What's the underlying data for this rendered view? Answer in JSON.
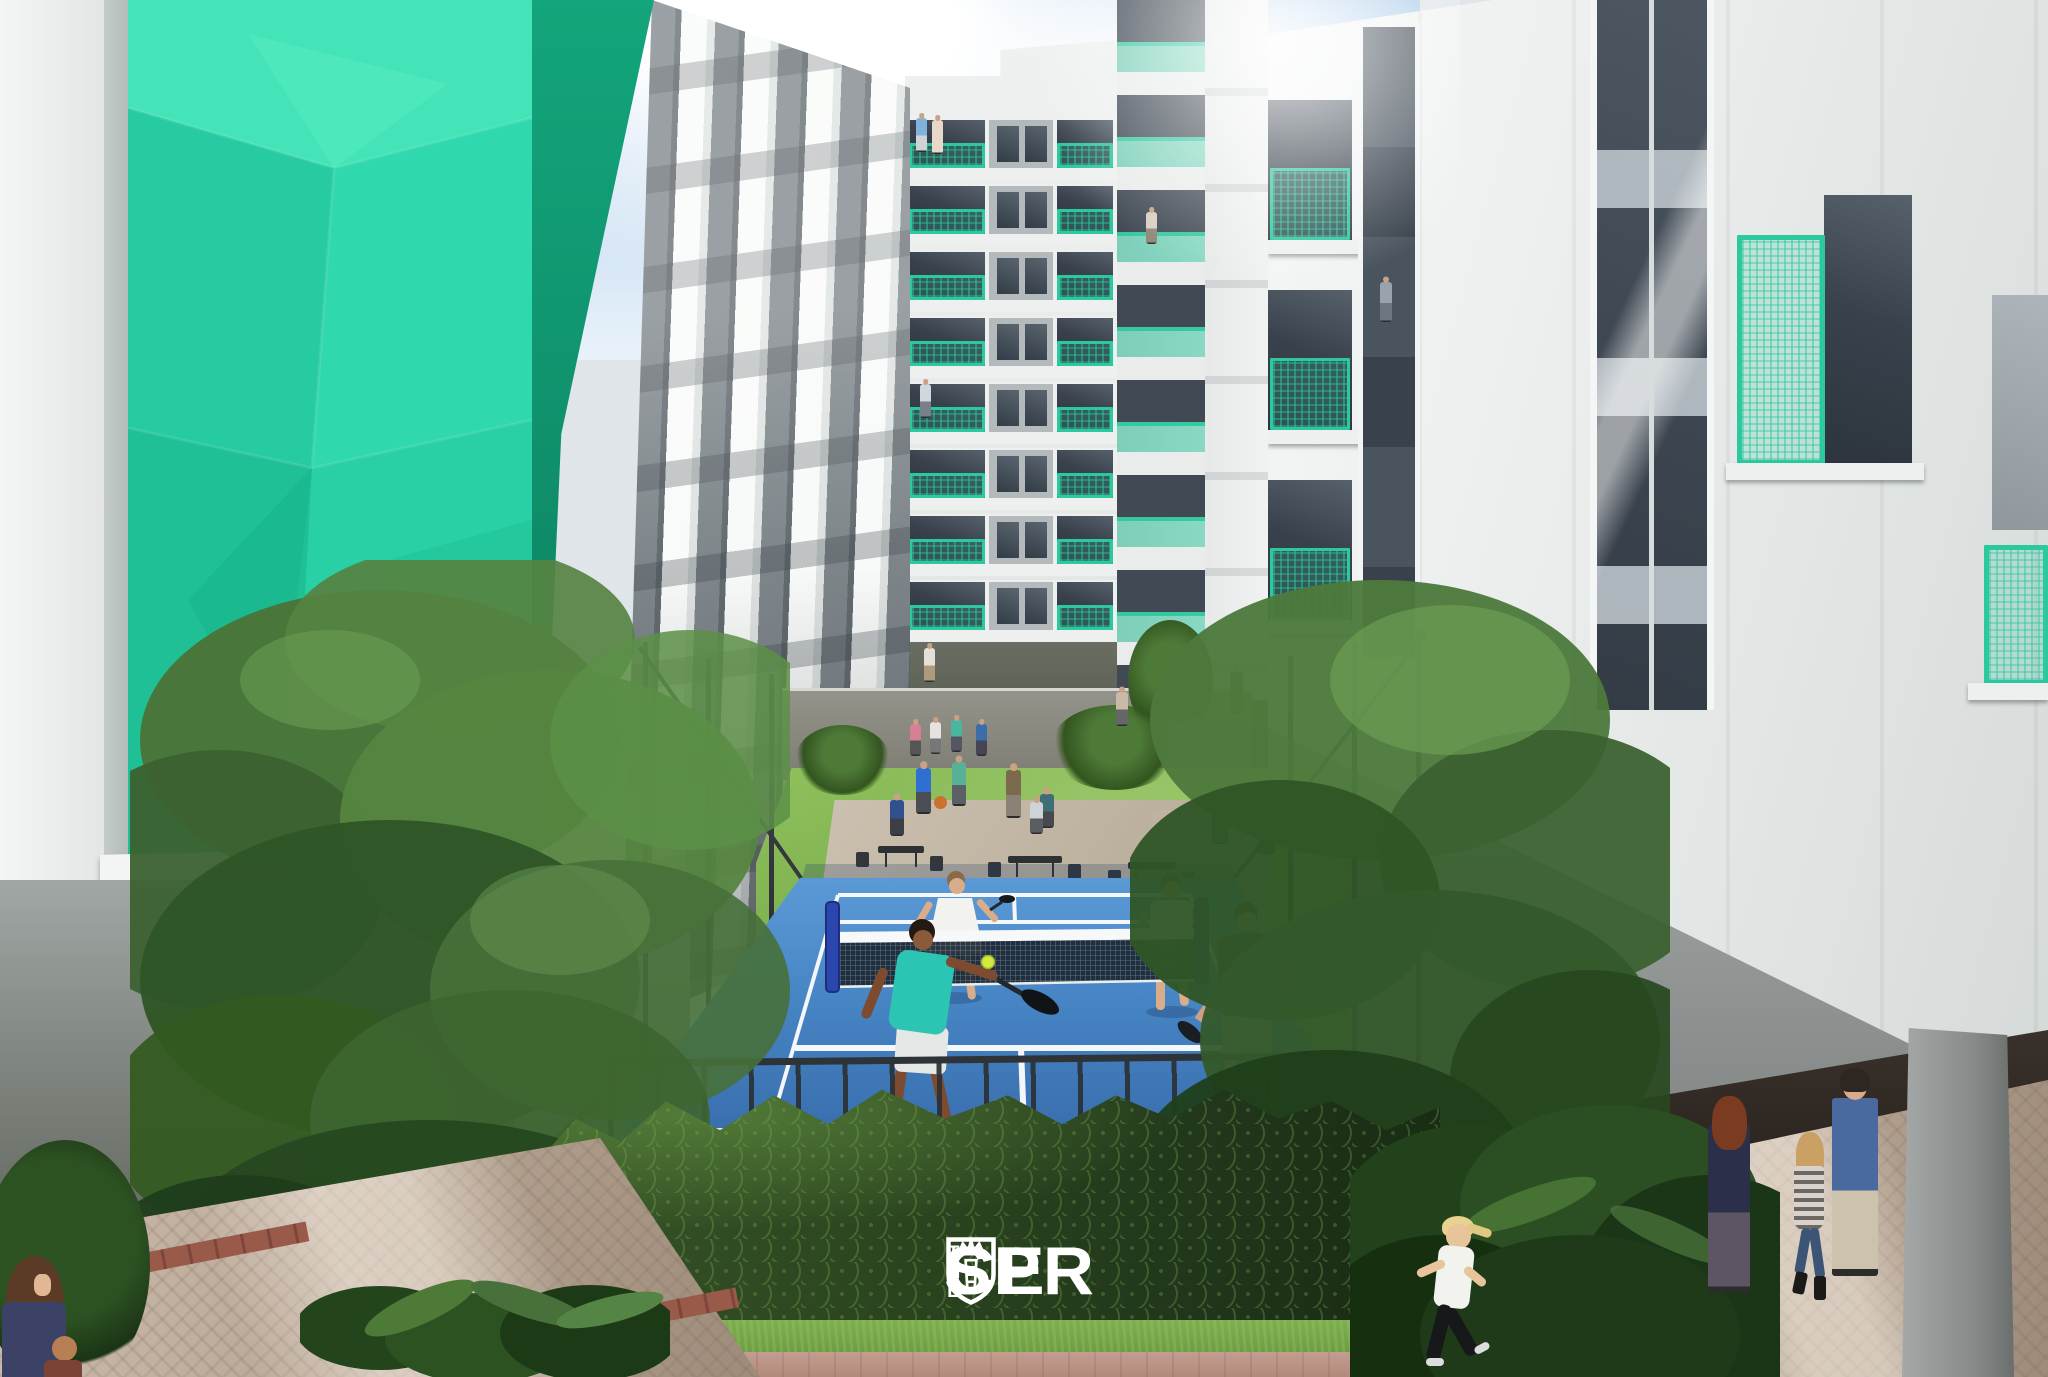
{
  "scene": {
    "logo": {
      "prefix": "THE",
      "part1": "SPR",
      "part2": "CE",
      "name": "SPRUCE",
      "crest_icon": "shield-crown-crest"
    },
    "colors": {
      "accent_teal": "#2ed3a7",
      "teal_side": "#129e77",
      "rail_teal": "#2cc89e",
      "court_blue": "#3f7ec0",
      "court_line": "#ffffff",
      "net_dark": "#1c2733",
      "post_blue": "#2b46ae",
      "lawn_green": "#84b955",
      "hedge_green": "#2c4722",
      "sky_blue": "#b9d6ee",
      "facade_white": "#eff1f0",
      "facade_gray": "#9aa2a5",
      "glass_dark": "#3a434e",
      "ground_olive": "#555a4f",
      "paver_tan": "#c3b2a1",
      "brick_red": "#9a5a49",
      "fence_dark": "#33383c",
      "ball_yellow": "#d4e93d"
    }
  }
}
